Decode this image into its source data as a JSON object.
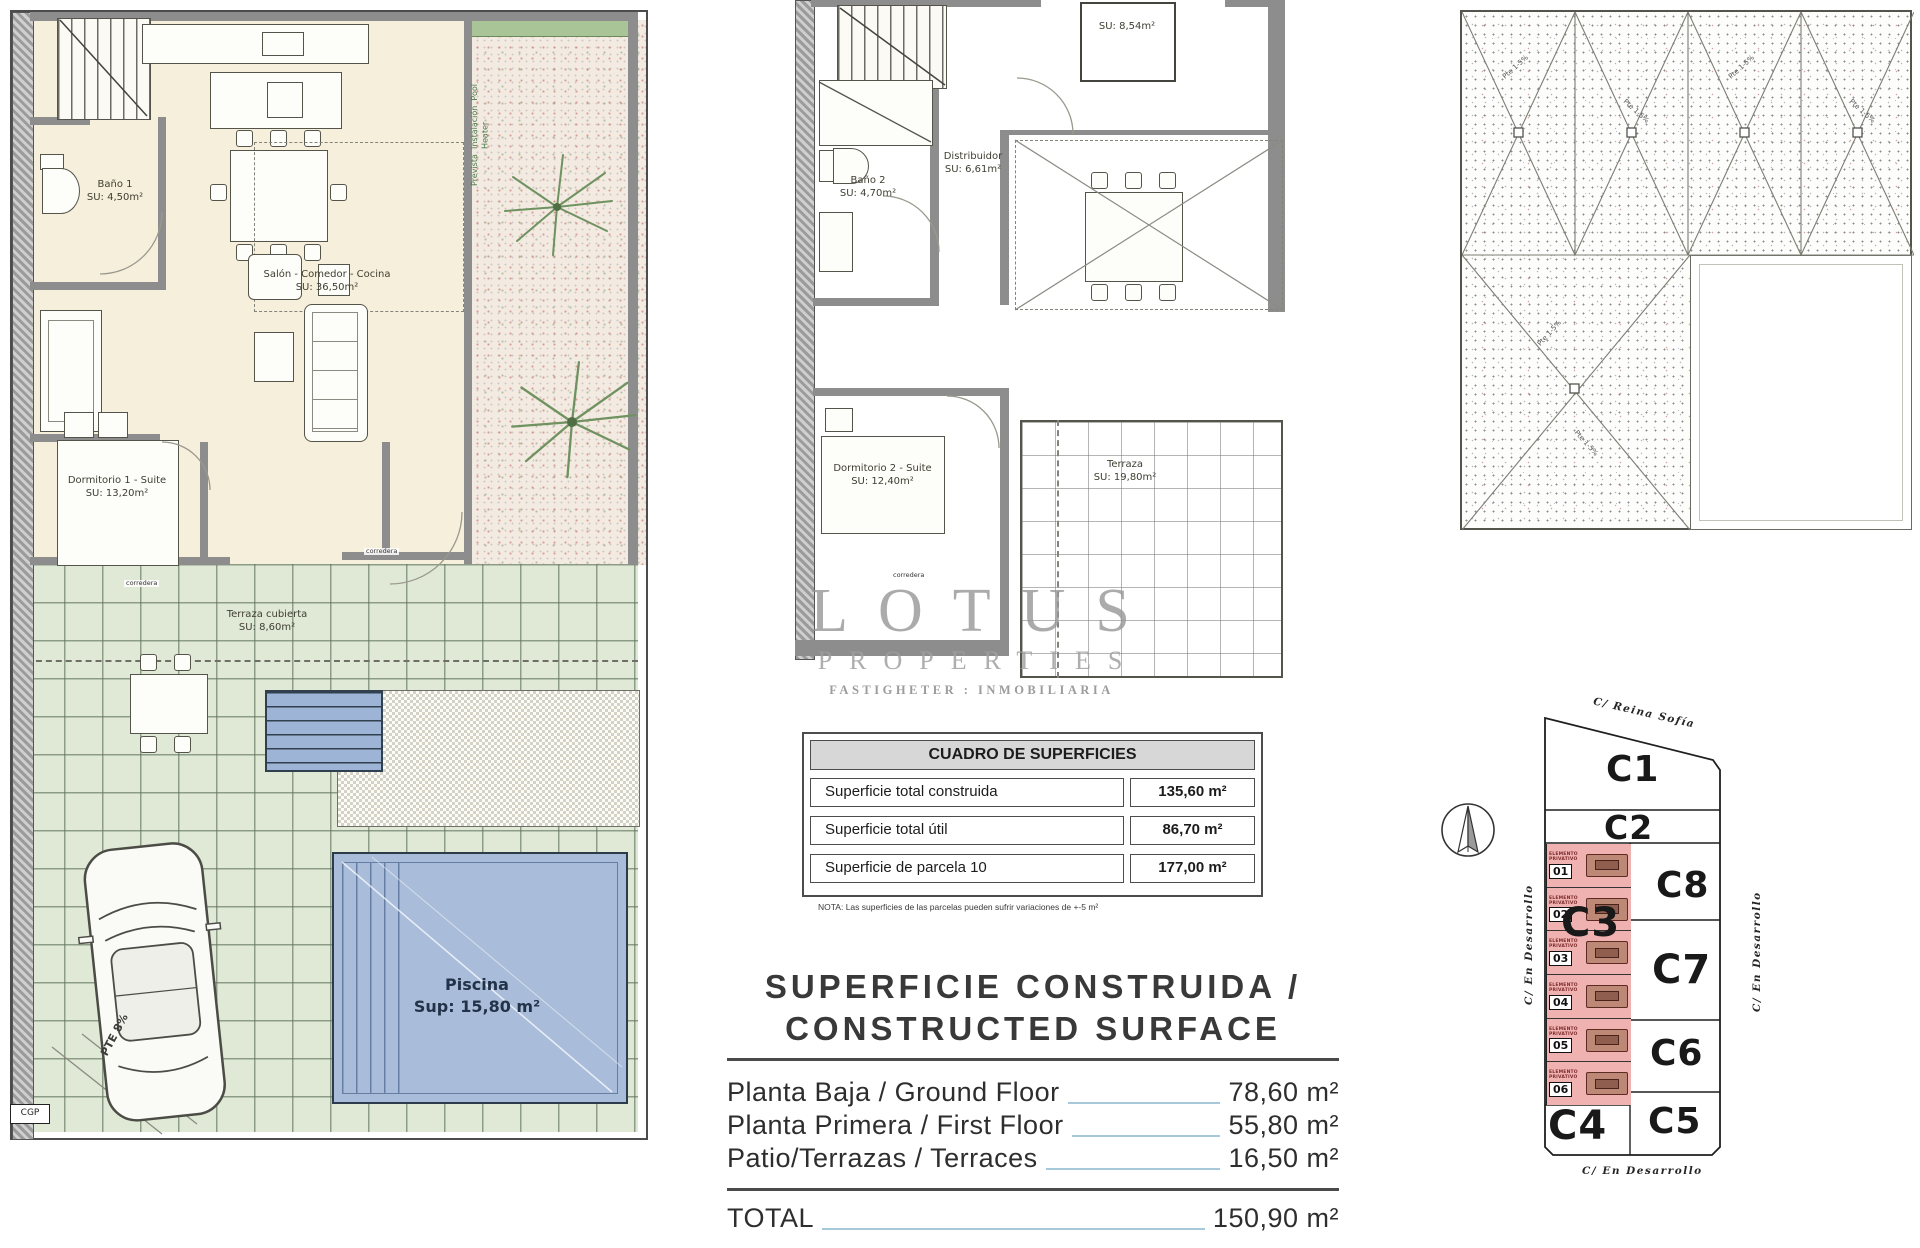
{
  "watermark": {
    "title": "LOTUS",
    "subtitle": "PROPERTIES",
    "tagline": "FASTIGHETER : INMOBILIARIA"
  },
  "ground_floor": {
    "bano1_name": "Baño 1",
    "bano1_area": "SU: 4,50m²",
    "salon_name": "Salón - Comedor - Cocina",
    "salon_area": "SU: 36,50m²",
    "dorm1_name": "Dormitorio 1 - Suite",
    "dorm1_area": "SU: 13,20m²",
    "terraza_name": "Terraza cubierta",
    "terraza_area": "SU: 8,60m²",
    "piscina_name": "Piscina",
    "piscina_area": "Sup: 15,80 m²",
    "corredera": "corredera",
    "cgp": "CGP",
    "ramp": "PTE 8%",
    "pool_heater_line1": "Prevista",
    "pool_heater_line2": "Instalación",
    "pool_heater_line3": "Pool Heater"
  },
  "first_floor": {
    "room_top_area": "SU: 8,54m²",
    "distribuidor_name": "Distribuidor",
    "distribuidor_area": "SU: 6,61m²",
    "bano2_name": "Baño 2",
    "bano2_area": "SU: 4,70m²",
    "dorm2_name": "Dormitorio 2 - Suite",
    "dorm2_area": "SU: 12,40m²",
    "terraza_name": "Terraza",
    "terraza_area": "SU: 19,80m²",
    "corredera": "corredera"
  },
  "roof_plan": {
    "slope_label": "Pte 1-5%"
  },
  "site_plan": {
    "street_top": "C/ Reina Sofía",
    "street_left": "C/ En Desarrollo",
    "street_right": "C/ En Desarrollo",
    "street_bottom": "C/ En Desarrollo",
    "plots": {
      "c1": "C1",
      "c2": "C2",
      "c3": "C3",
      "c4": "C4",
      "c5": "C5",
      "c6": "C6",
      "c7": "C7",
      "c8": "C8"
    },
    "unit_label_line1": "ELEMENTO",
    "unit_label_line2": "PRIVATIVO",
    "units": [
      "01",
      "02",
      "03",
      "04",
      "05",
      "06"
    ]
  },
  "areas_table": {
    "title": "CUADRO DE SUPERFICIES",
    "rows": [
      {
        "label": "Superficie total construida",
        "value": "135,60 m²"
      },
      {
        "label": "Superficie total útil",
        "value": "86,70 m²"
      },
      {
        "label": "Superficie de parcela 10",
        "value": "177,00 m²"
      }
    ],
    "note": "NOTA: Las superficies de las parcelas pueden sufrir variaciones de +-5 m²"
  },
  "surface_summary": {
    "title_line1": "SUPERFICIE CONSTRUIDA /",
    "title_line2": "CONSTRUCTED SURFACE",
    "rows": [
      {
        "label": "Planta Baja / Ground Floor",
        "value": "78,60 m²"
      },
      {
        "label": "Planta Primera / First Floor",
        "value": "55,80 m²"
      },
      {
        "label": "Patio/Terrazas / Terraces",
        "value": "16,50 m²"
      }
    ],
    "total_label": "TOTAL",
    "total_value": "150,90 m²"
  }
}
